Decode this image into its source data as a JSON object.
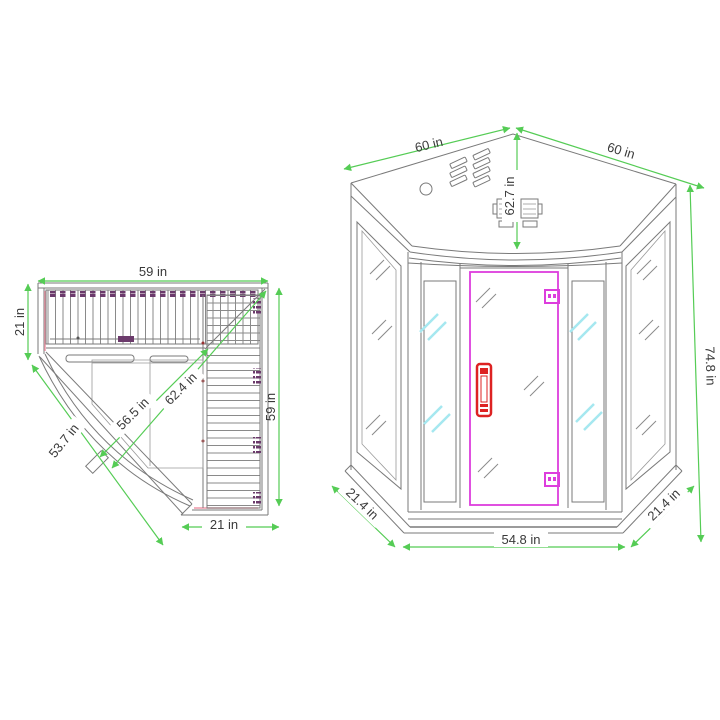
{
  "diagram": {
    "subject": "corner-sauna-dimension-drawing",
    "views": {
      "plan": {
        "dimensions": {
          "top_width": "59 in",
          "left_depth": "21 in",
          "front_diagonal": "53.7 in",
          "inner_diagonal_short": "56.5 in",
          "inner_diagonal_long": "62.4 in",
          "right_depth": "59 in",
          "bottom_width": "21 in"
        }
      },
      "front": {
        "dimensions": {
          "roof_edge_left": "60 in",
          "roof_edge_right": "60 in",
          "roof_depth": "62.7 in",
          "total_height": "74.8 in",
          "base_side_left": "21.4 in",
          "base_side_right": "21.4 in",
          "base_front_width": "54.8 in"
        }
      }
    },
    "colors": {
      "dimension_line": "#55cc55",
      "label_text": "#3a3a3a",
      "drawing_line": "#7a7a7a",
      "door_frame": "#dd3ddd",
      "door_handle": "#dd2222",
      "glass_highlight": "#a5e8f0",
      "heater_accent": "#6b3a6b",
      "trim_accent": "#ef97a8",
      "background": "#ffffff"
    }
  }
}
